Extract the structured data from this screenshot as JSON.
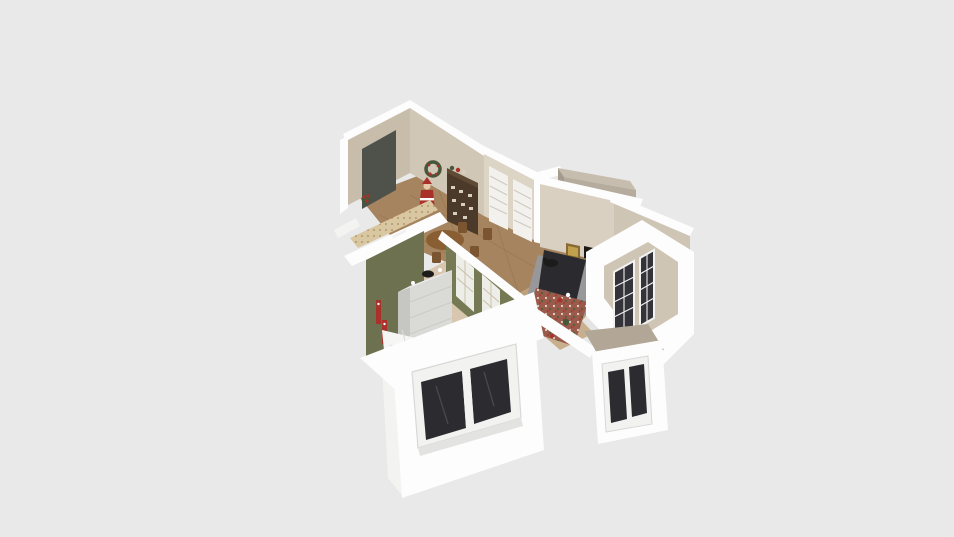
{
  "scene": {
    "type": "3d-floorplan-cutaway-render",
    "objects": [
      "entry-door",
      "poinsettia",
      "wreath",
      "santa-figure",
      "china-hutch",
      "dining-table",
      "dining-chairs",
      "blinds-window",
      "fireplace",
      "fireplace-artwork",
      "chimney",
      "chaise-lounge",
      "gray-rug",
      "festive-rug",
      "reindeer-figure",
      "black-cat",
      "wallpaper-half-wall",
      "bedroom-french-doors",
      "bedroom-dresser",
      "dresser-cat",
      "candle-figures",
      "bed",
      "south-exterior-window",
      "east-exterior-window",
      "east-wing-french-windows"
    ]
  },
  "colors": {
    "bg": "#e9e9e9",
    "white": "#fdfdfd",
    "white_dim": "#f3f3f2",
    "white_shade": "#e4e4e3",
    "beige": "#c8bdab",
    "beige2": "#d1c7b6",
    "beige3": "#dcd4c5",
    "tan_wall": "#d9d0c1",
    "tan_interior": "#cfc5b4",
    "tan_top": "#b2a796",
    "chimney": "#b6ac9d",
    "chimney_top": "#c6bdae",
    "chimney_side": "#a59b8c",
    "door_dark": "#4e524b",
    "olive": "#6d7150",
    "olive2": "#767a54",
    "wood_floor": "#a5845f",
    "wood_line": "#8a6b46",
    "hall_tile": "#c2a67f",
    "carpet": "#d8c6ae",
    "wallpaper": "#d9c7a1",
    "wallpaper_dot": "#b2976c",
    "hutch": "#4b3929",
    "hutch_top": "#5f4a35",
    "dish": "#d8cebe",
    "table_wood": "#8a5e33",
    "chair_wood": "#7b5530",
    "rug_gray": "#98989a",
    "chaise": "#2b2b2f",
    "rug_red": "#9a5a4c",
    "rug_dot_white": "#e3d7c8",
    "rug_dot_green": "#4e5e3a",
    "glass_dark": "#2c2c30",
    "glass_dark2": "#34333a",
    "frame_white": "#f2f2f1",
    "frame_gray": "#d8d8d7",
    "blind_white": "#f2f1ee",
    "blind_line": "#cfc9bd",
    "fire": "#e08a2e",
    "fire_core": "#f3c265",
    "firebox": "#1f1913",
    "art_gold": "#c2a14e",
    "art_frame": "#8a6a33",
    "red": "#a93129",
    "green_dark": "#46573a",
    "bed_white": "#f6f6f4",
    "bed_line": "#dcdcda",
    "dresser_front": "#dadad7",
    "dresser_side": "#c6c6c3",
    "dresser_top": "#ebebe9",
    "deer": "#7b583a",
    "skin": "#e8c9a8",
    "cat": "#1c1c1c",
    "door_pane_line": "#c9bda6",
    "door_cream": "#eeeee9",
    "sill": "#e3e3e2"
  }
}
